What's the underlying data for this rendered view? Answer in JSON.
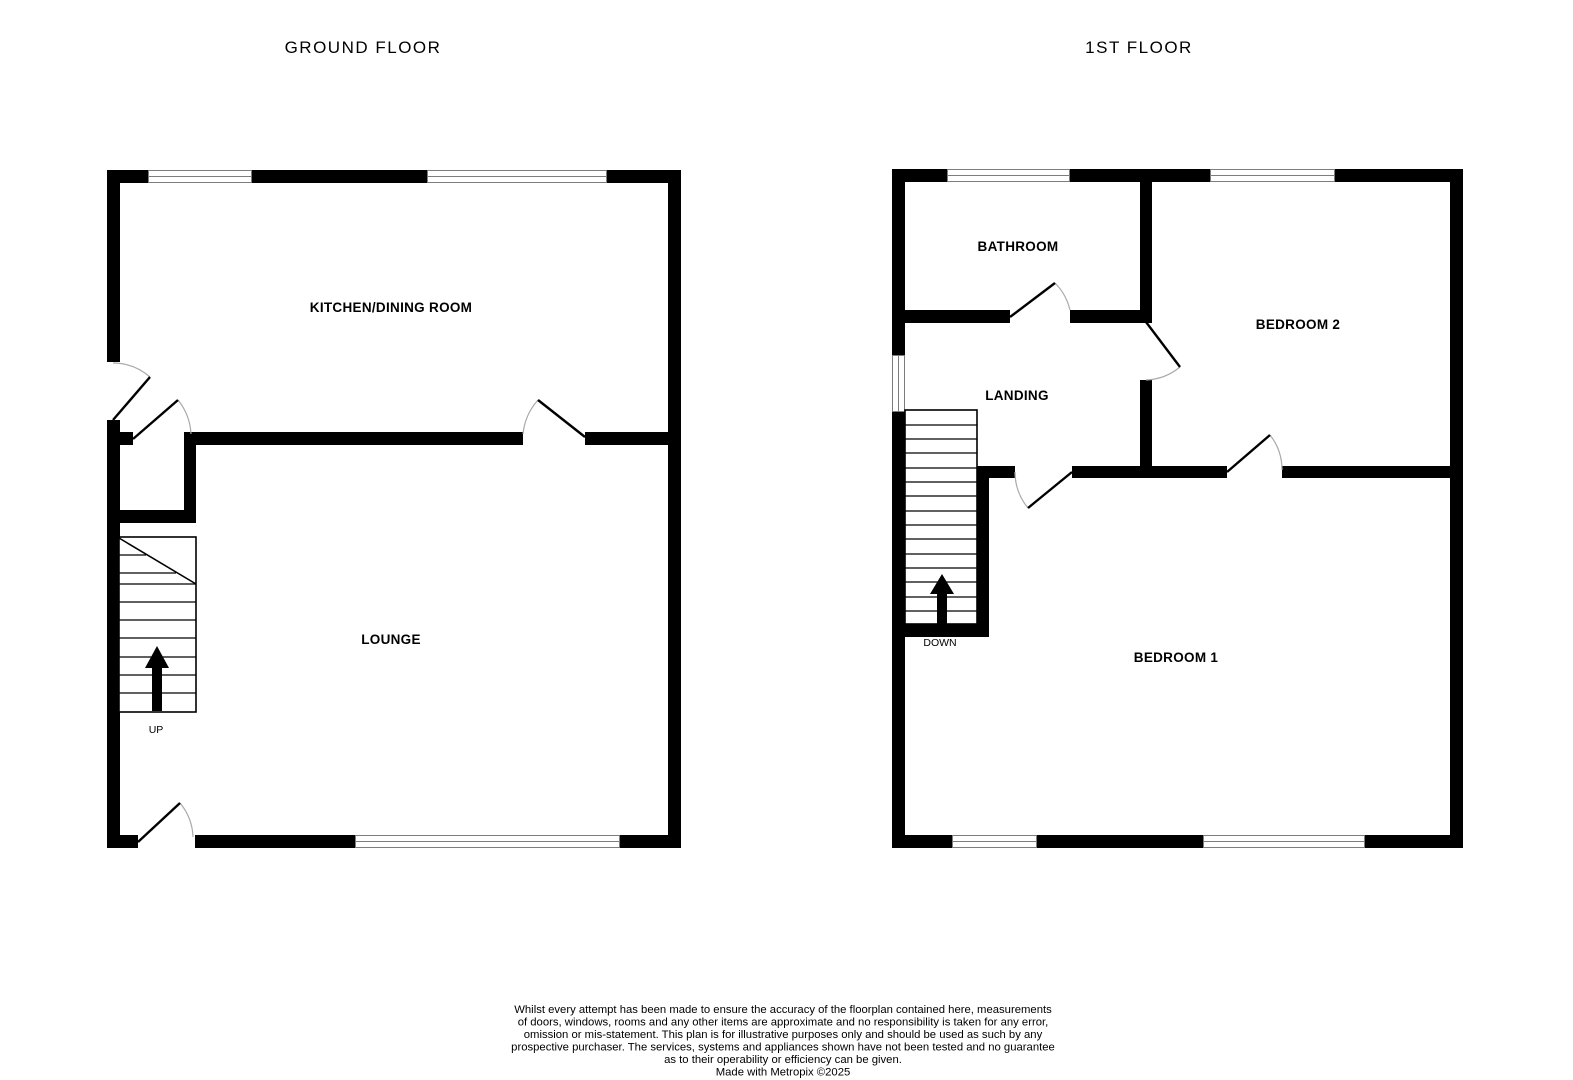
{
  "titles": {
    "ground": "GROUND FLOOR",
    "first": "1ST FLOOR"
  },
  "ground_floor": {
    "rooms": [
      {
        "label": "KITCHEN/DINING ROOM"
      },
      {
        "label": "LOUNGE"
      }
    ],
    "stairs_label": "UP"
  },
  "first_floor": {
    "rooms": [
      {
        "label": "BATHROOM"
      },
      {
        "label": "LANDING"
      },
      {
        "label": "BEDROOM 2"
      },
      {
        "label": "BEDROOM 1"
      }
    ],
    "stairs_label": "DOWN"
  },
  "disclaimer": {
    "lines": [
      "Whilst every attempt has been made to ensure the accuracy of the floorplan contained here, measurements",
      "of doors, windows, rooms and any other items are approximate and no responsibility is taken for any error,",
      "omission or mis-statement. This plan is for illustrative purposes only and should be used as such by any",
      "prospective purchaser. The services, systems and appliances shown have not been tested and no guarantee",
      "as to their operability or efficiency can be given."
    ],
    "credit": "Made with Metropix ©2025"
  },
  "colors": {
    "wall": "#000000",
    "window_outline": "#7d7d7d",
    "door_arc": "#a9a9a9",
    "text": "#000000",
    "background": "#ffffff"
  }
}
